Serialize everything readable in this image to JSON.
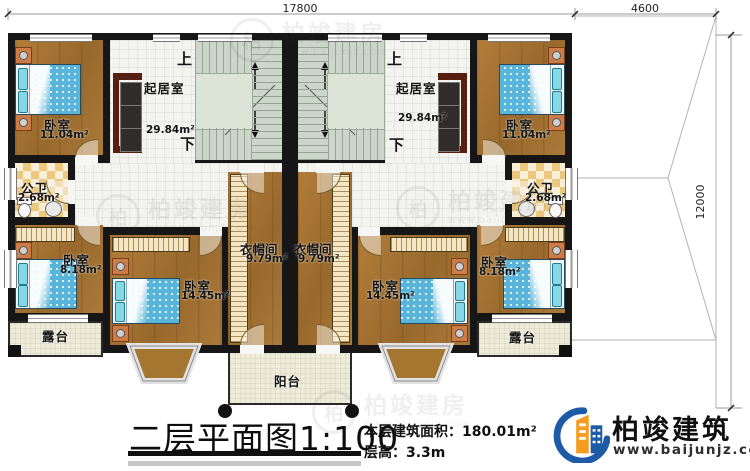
{
  "dimensions": {
    "top_width": "17800",
    "wing_width": "4600",
    "wing_height": "12000"
  },
  "stairs": {
    "up": "上",
    "down": "下"
  },
  "rooms": {
    "living_left": {
      "name": "起居室",
      "area": "29.84m²"
    },
    "living_right": {
      "name": "起居室",
      "area": "29.84m²"
    },
    "bedroom_top_left": {
      "name": "卧室",
      "area": "11.04m²"
    },
    "bedroom_top_right": {
      "name": "卧室",
      "area": "11.04m²"
    },
    "bath_left": {
      "name": "公卫",
      "area": "2.68m²"
    },
    "bath_right": {
      "name": "公卫",
      "area": "2.68m²"
    },
    "bedroom_small_left": {
      "name": "卧室",
      "area": "8.18m²"
    },
    "bedroom_small_right": {
      "name": "卧室",
      "area": "8.18m²"
    },
    "bedroom_mid_left": {
      "name": "卧室",
      "area": "14.45m²"
    },
    "bedroom_mid_right": {
      "name": "卧室",
      "area": "14.45m²"
    },
    "cloak_left": {
      "name": "衣帽间",
      "area": "9.79m²"
    },
    "cloak_right": {
      "name": "衣帽间",
      "area": "9.79m²"
    },
    "terrace_left": {
      "name": "露台"
    },
    "terrace_right": {
      "name": "露台"
    },
    "balcony": {
      "name": "阳台"
    }
  },
  "footer": {
    "title": "二层平面图",
    "scale": "1:100",
    "area_label": "本层建筑面积：",
    "area_value": "180.01m²",
    "floor_height_label": "层高：",
    "floor_height_value": "3.3m"
  },
  "brand": {
    "name": "柏竣建筑",
    "website": "www.baijunjz.com"
  },
  "watermark": {
    "initial": "柏",
    "text": "柏竣建房",
    "subtext": "www.baijunjz.com"
  }
}
